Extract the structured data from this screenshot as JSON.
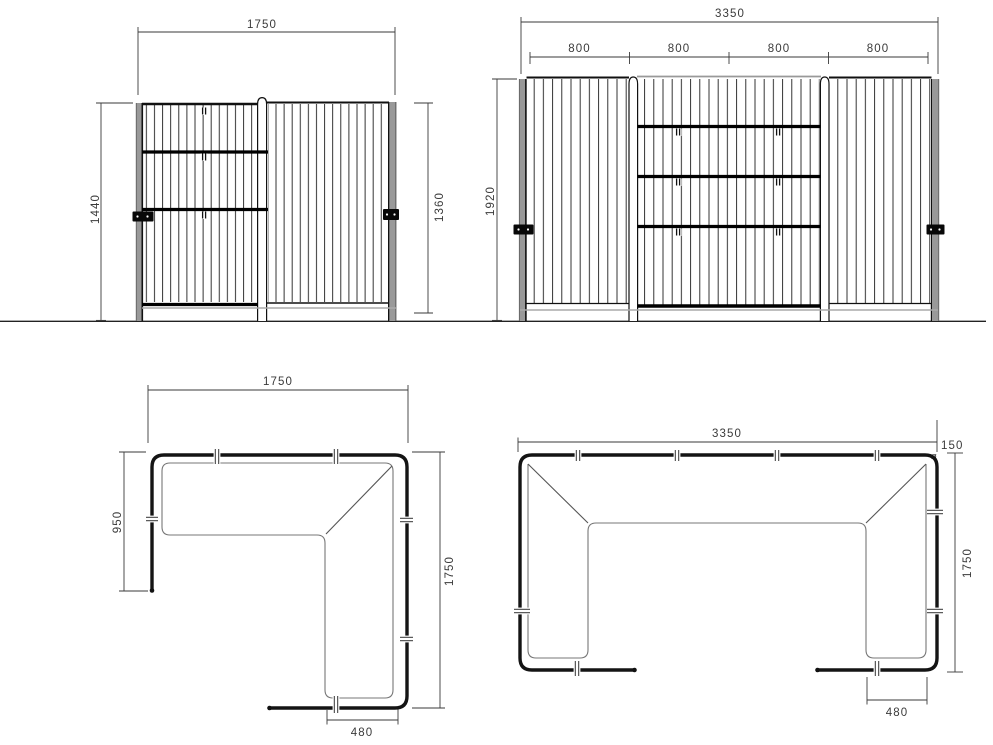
{
  "drawing": {
    "elevation_corner": {
      "width": "1750",
      "height_total": "1440",
      "height_panel": "1360"
    },
    "elevation_straight": {
      "width_total": "3350",
      "panel_widths": [
        "800",
        "800",
        "800",
        "800"
      ],
      "height_total": "1920"
    },
    "plan_corner": {
      "width": "1750",
      "side_depth": "950",
      "depth": "1750",
      "panel_depth": "480"
    },
    "plan_straight": {
      "width_total": "3350",
      "tube_diameter": "150",
      "diameter_symbol": "ø",
      "depth": "1750",
      "panel_depth": "480"
    },
    "colors": {
      "line": "#1a1a1a",
      "dimension": "#3a3a3a",
      "post_gray": "#999999",
      "inner_gray": "#777777",
      "background": "#ffffff"
    }
  }
}
